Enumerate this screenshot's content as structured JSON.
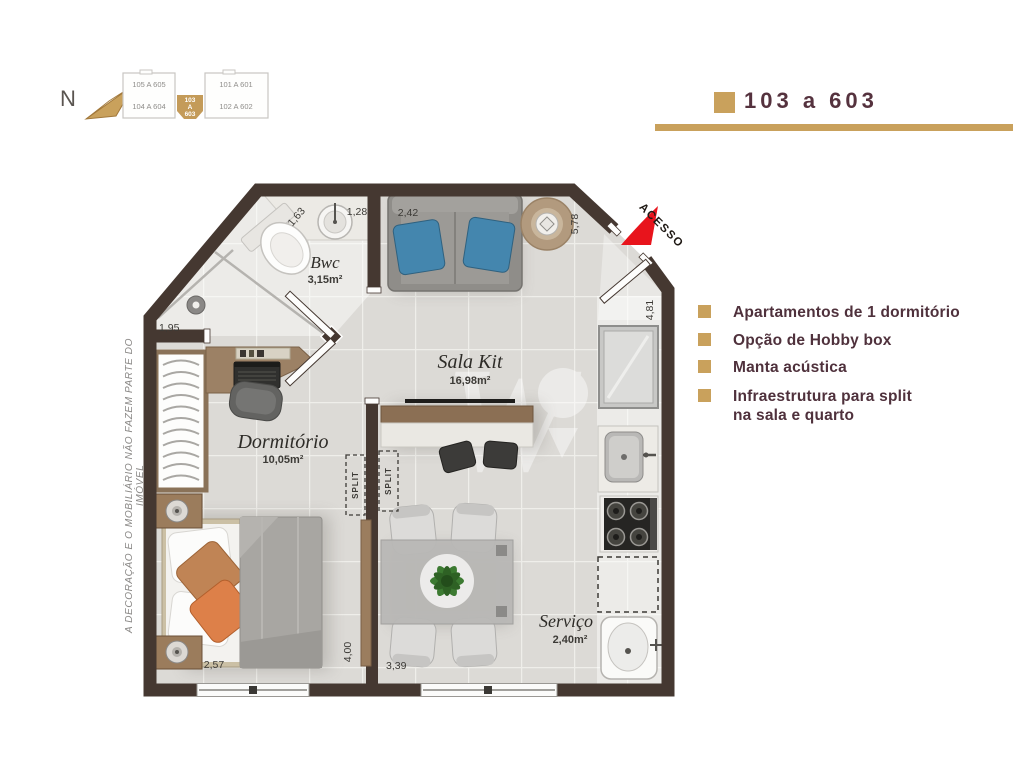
{
  "header": {
    "north_label": "N",
    "unit_title": "103 a 603"
  },
  "key_plan": {
    "unit_top_left": "105 A 605",
    "unit_bottom_left": "104 A 604",
    "unit_top_right": "101 A 601",
    "unit_bottom_right": "102 A 602",
    "highlighted_unit": {
      "line1": "103",
      "line2": "A",
      "line3": "603"
    }
  },
  "features": [
    {
      "label": "Apartamentos de 1 dormitório"
    },
    {
      "label": "Opção de Hobby box"
    },
    {
      "label": "Manta acústica"
    },
    {
      "label": "Infraestrutura para split",
      "label2": "na sala e quarto"
    }
  ],
  "plan": {
    "rooms": {
      "bwc": {
        "name": "Bwc",
        "area": "3,15m²"
      },
      "sala": {
        "name": "Sala Kit",
        "area": "16,98m²"
      },
      "dormitorio": {
        "name": "Dormitório",
        "area": "10,05m²"
      },
      "servico": {
        "name": "Serviço",
        "area": "2,40m²"
      }
    },
    "dimensions": {
      "bwc_diag": "1,63",
      "bwc_top": "1,28",
      "sofa_top": "2,42",
      "sala_right": "5,78",
      "entry_diag": "4,81",
      "bwc_left": "1,95",
      "dorm_bottom": "2,57",
      "partition": "4,00",
      "sala_bottom": "3,39"
    },
    "annotations": {
      "access": "ACESSO",
      "split_dorm": "SPLIT",
      "split_sala": "SPLIT"
    }
  },
  "disclaimer": "A  DECORAÇÃO E O MOBILIÁRIO NÃO FAZEM PARTE DO IMÓVEL",
  "colors": {
    "gold": "#c9a15c",
    "maroon": "#55323e",
    "wall_brown": "#453831",
    "access_red": "#e8141c",
    "cushion_blue": "#4486ae"
  }
}
